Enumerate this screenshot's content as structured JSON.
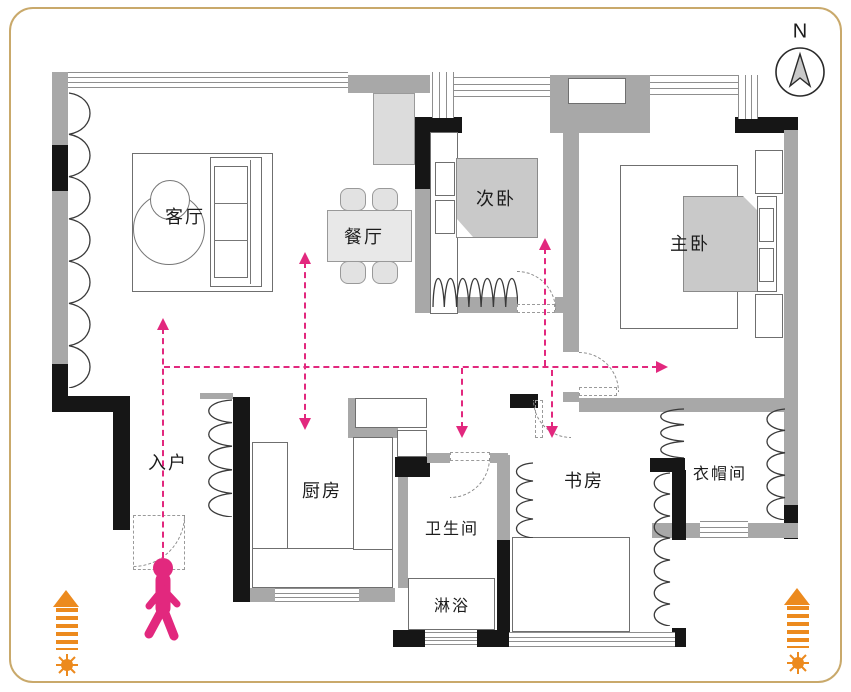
{
  "compass": {
    "label": "N"
  },
  "rooms": {
    "living": "客厅",
    "dining": "餐厅",
    "second_bedroom": "次卧",
    "master_bedroom": "主卧",
    "entry": "入户",
    "kitchen": "厨房",
    "bathroom": "卫生间",
    "shower": "淋浴",
    "study": "书房",
    "cloakroom": "衣帽间"
  },
  "colors": {
    "accent_pink": "#E2287E",
    "accent_orange": "#EC8A1E",
    "wall_gray": "#A8A8A8",
    "wall_black": "#161616",
    "frame_tan": "#C9A96B",
    "furniture_fill": "#C9C9C9"
  }
}
